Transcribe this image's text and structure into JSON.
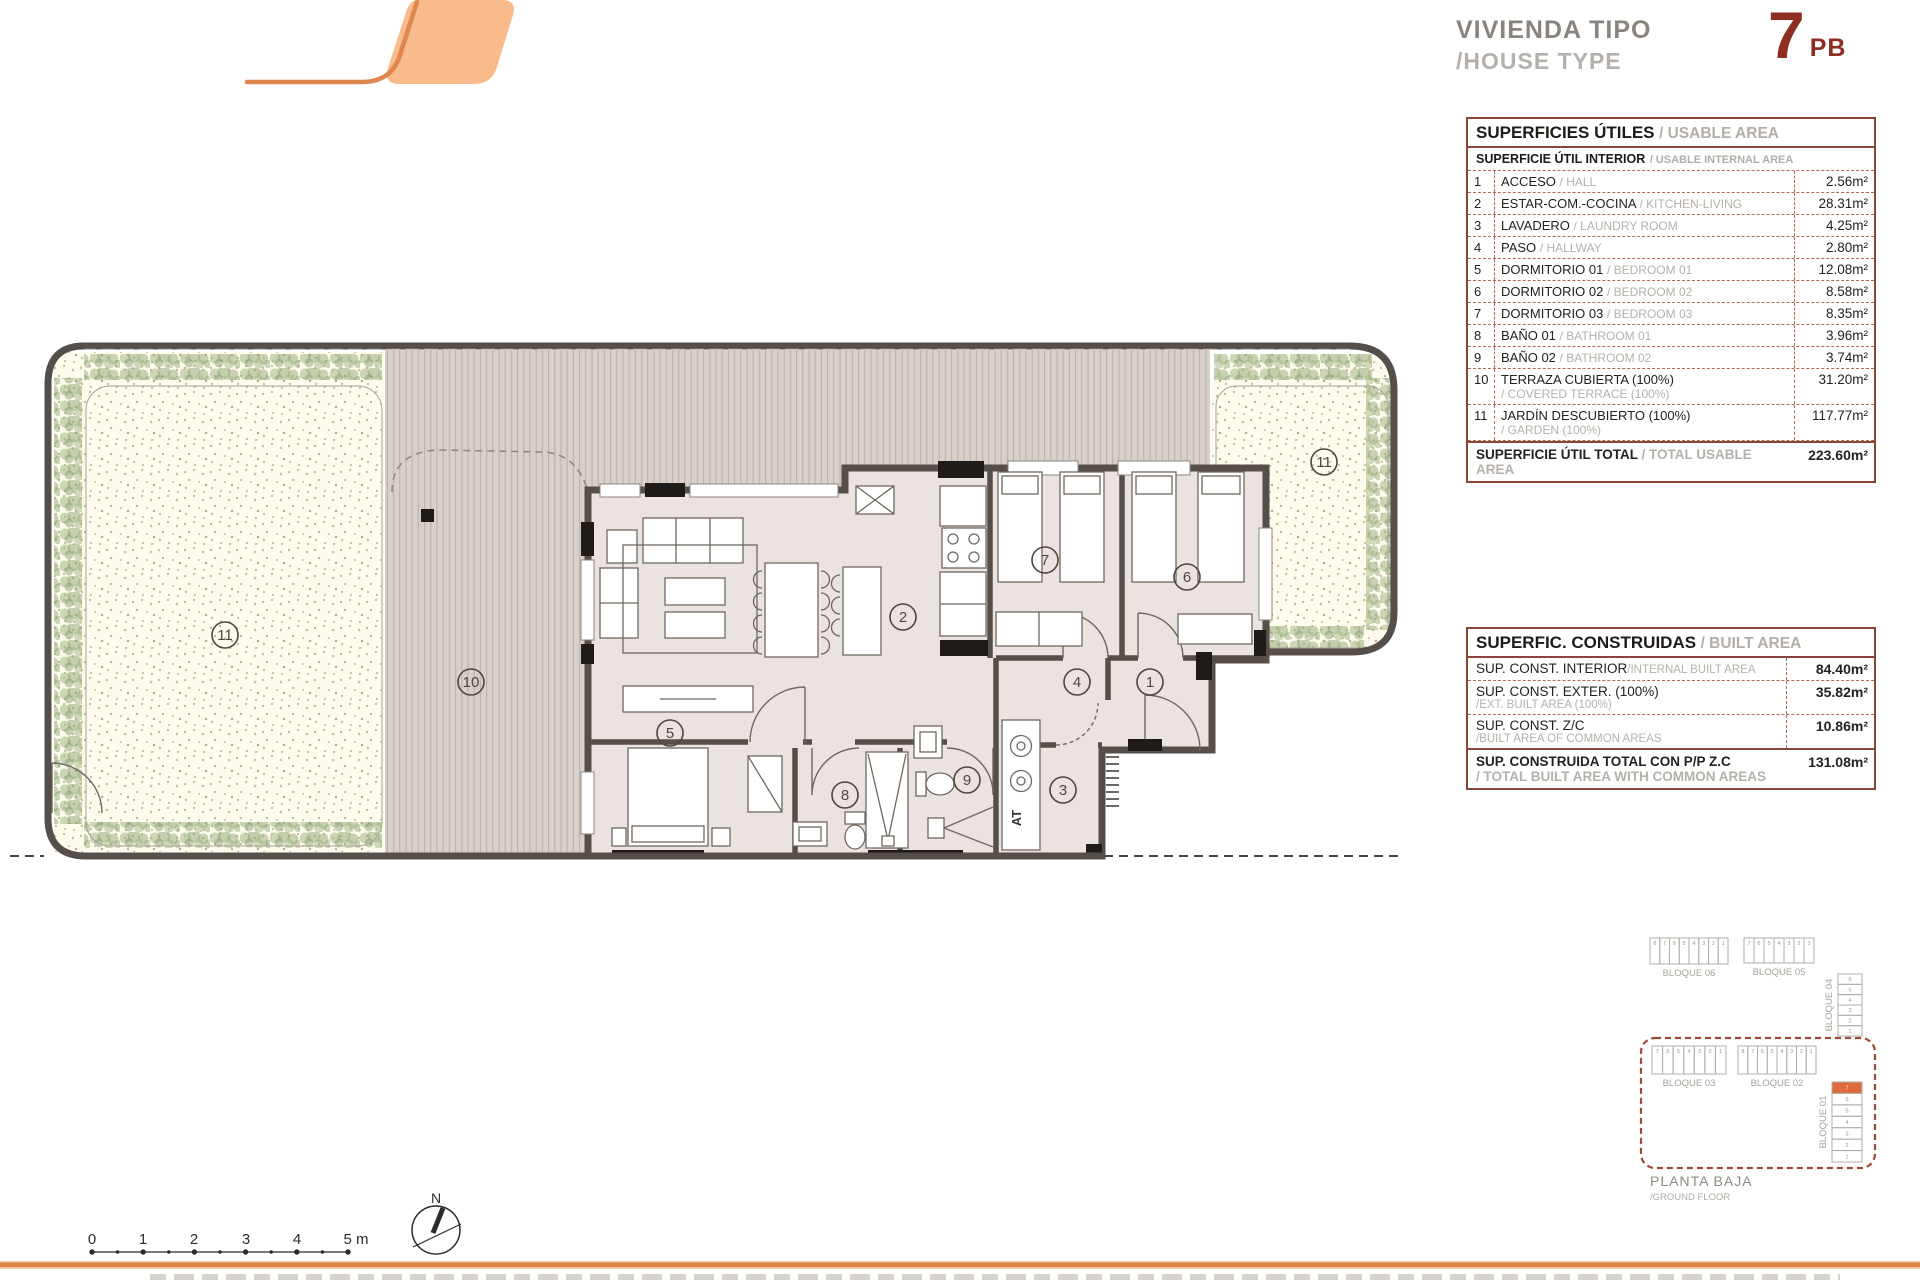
{
  "header": {
    "title_es": "VIVIENDA TIPO",
    "title_en": "/HOUSE TYPE",
    "unit_number": "7",
    "unit_suffix": "PB"
  },
  "usable_table": {
    "title_es": "SUPERFICIES ÚTILES",
    "title_en": "/ USABLE AREA",
    "sub_es": "SUPERFICIE ÚTIL INTERIOR",
    "sub_en": "/ USABLE INTERNAL AREA",
    "rows": [
      {
        "num": "1",
        "es": "ACCESO",
        "en": "/ HALL",
        "value": "2.56m²"
      },
      {
        "num": "2",
        "es": "ESTAR-COM.-COCINA",
        "en": "/ KITCHEN-LIVING",
        "value": "28.31m²"
      },
      {
        "num": "3",
        "es": "LAVADERO",
        "en": "/ LAUNDRY ROOM",
        "value": "4.25m²"
      },
      {
        "num": "4",
        "es": "PASO",
        "en": "/ HALLWAY",
        "value": "2.80m²"
      },
      {
        "num": "5",
        "es": "DORMITORIO 01",
        "en": "/ BEDROOM 01",
        "value": "12.08m²"
      },
      {
        "num": "6",
        "es": "DORMITORIO 02",
        "en": "/ BEDROOM 02",
        "value": "8.58m²"
      },
      {
        "num": "7",
        "es": "DORMITORIO 03",
        "en": "/ BEDROOM 03",
        "value": "8.35m²"
      },
      {
        "num": "8",
        "es": "BAÑO 01",
        "en": "/ BATHROOM 01",
        "value": "3.96m²"
      },
      {
        "num": "9",
        "es": "BAÑO 02",
        "en": "/ BATHROOM 02",
        "value": "3.74m²"
      },
      {
        "num": "10",
        "es": "TERRAZA CUBIERTA (100%)",
        "en": "/ COVERED TERRACE (100%)",
        "value": "31.20m²"
      },
      {
        "num": "11",
        "es": "JARDÍN DESCUBIERTO (100%)",
        "en": "/ GARDEN (100%)",
        "value": "117.77m²"
      }
    ],
    "total_es": "SUPERFICIE ÚTIL TOTAL",
    "total_en": "/ TOTAL USABLE AREA",
    "total_value": "223.60m²"
  },
  "built_table": {
    "title_es": "SUPERFIC. CONSTRUIDAS",
    "title_en": "/ BUILT AREA",
    "rows": [
      {
        "es": "SUP. CONST. INTERIOR",
        "en": "/INTERNAL BUILT AREA",
        "value": "84.40m²"
      },
      {
        "es": "SUP. CONST. EXTER. (100%)",
        "en": "/EXT. BUILT AREA (100%)",
        "value": "35.82m²"
      },
      {
        "es": "SUP. CONST. Z/C",
        "en": "/BUILT AREA OF COMMON AREAS",
        "value": "10.86m²"
      }
    ],
    "total_es": "SUP. CONSTRUIDA TOTAL CON P/P Z.C",
    "total_en": "/ TOTAL BUILT AREA WITH COMMON AREAS",
    "total_value": "131.08m²"
  },
  "plan": {
    "rooms": [
      "1",
      "2",
      "3",
      "4",
      "5",
      "6",
      "7",
      "8",
      "9",
      "10",
      "11"
    ],
    "at_label": "AT"
  },
  "key_plan": {
    "caption_es": "PLANTA BAJA",
    "caption_en": "/GROUND FLOOR",
    "blocks": [
      {
        "label": "BLOQUE 06",
        "cells": [
          "8",
          "7",
          "6",
          "5",
          "4",
          "3",
          "2",
          "1"
        ]
      },
      {
        "label": "BLOQUE 05",
        "cells": [
          "7",
          "6",
          "5",
          "4",
          "3",
          "2",
          "1"
        ]
      },
      {
        "label": "BLOQUE 04",
        "cells": [
          "6",
          "5",
          "4",
          "3",
          "2",
          "1"
        ]
      },
      {
        "label": "BLOQUE 03",
        "cells": [
          "7",
          "6",
          "5",
          "4",
          "3",
          "2",
          "1"
        ]
      },
      {
        "label": "BLOQUE 02",
        "cells": [
          "8",
          "7",
          "6",
          "5",
          "4",
          "3",
          "2",
          "1"
        ]
      },
      {
        "label": "BLOQUE 01",
        "cells": [
          "7",
          "6",
          "5",
          "4",
          "3",
          "2",
          "1"
        ]
      }
    ],
    "highlight": {
      "block_index": 5,
      "cell_index": 0
    }
  },
  "scale_bar": {
    "labels": [
      "0",
      "1",
      "2",
      "3",
      "4",
      "5 m"
    ]
  },
  "compass": {
    "label": "N"
  },
  "colors": {
    "accent_orange": "#db8445",
    "logo_fill": "#f9bb8c",
    "maroon": "#8e2d22",
    "table_border": "#8a4536",
    "wall": "#554e49",
    "terrace": "#d8d0c9",
    "garden": "#fdfbee",
    "highlight_cell": "#dd6b3d"
  }
}
